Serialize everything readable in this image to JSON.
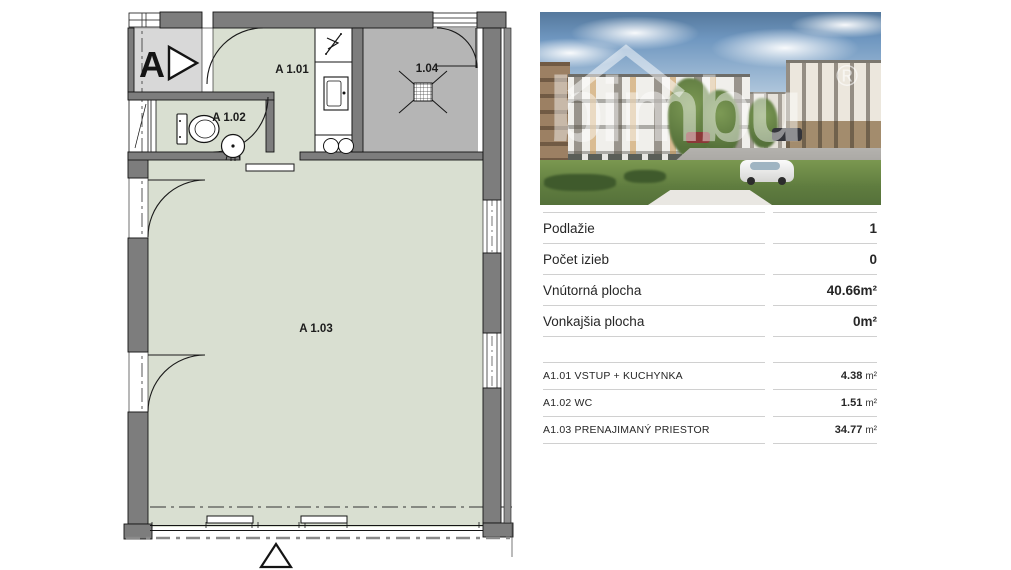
{
  "floorplan": {
    "section_label": "A",
    "rooms": [
      {
        "id": "A 1.01"
      },
      {
        "id": "A 1.02"
      },
      {
        "id": "A 1.03"
      },
      {
        "id": "1.04"
      }
    ]
  },
  "photo": {
    "watermark": "bimbu",
    "registered": "®"
  },
  "details_table": {
    "rows": [
      {
        "label": "Podlažie",
        "value": "1"
      },
      {
        "label": "Počet izieb",
        "value": "0"
      },
      {
        "label": "Vnútorná plocha",
        "value": "40.66m²"
      },
      {
        "label": "Vonkajšia plocha",
        "value": "0m²"
      }
    ]
  },
  "rooms_table": {
    "rows": [
      {
        "label": "A1.01 VSTUP + KUCHYNKA",
        "value": "4.38",
        "unit": "m²"
      },
      {
        "label": "A1.02 WC",
        "value": "1.51",
        "unit": "m²"
      },
      {
        "label": "A1.03 PRENAJIMANÝ PRIESTOR",
        "value": "34.77",
        "unit": "m²"
      }
    ]
  },
  "colors": {
    "room_fill": "#d9dfd1",
    "shaft_fill": "#b5b5b5",
    "wall_fill": "#7d7d7d",
    "divider_line": "#d0d0d0"
  }
}
